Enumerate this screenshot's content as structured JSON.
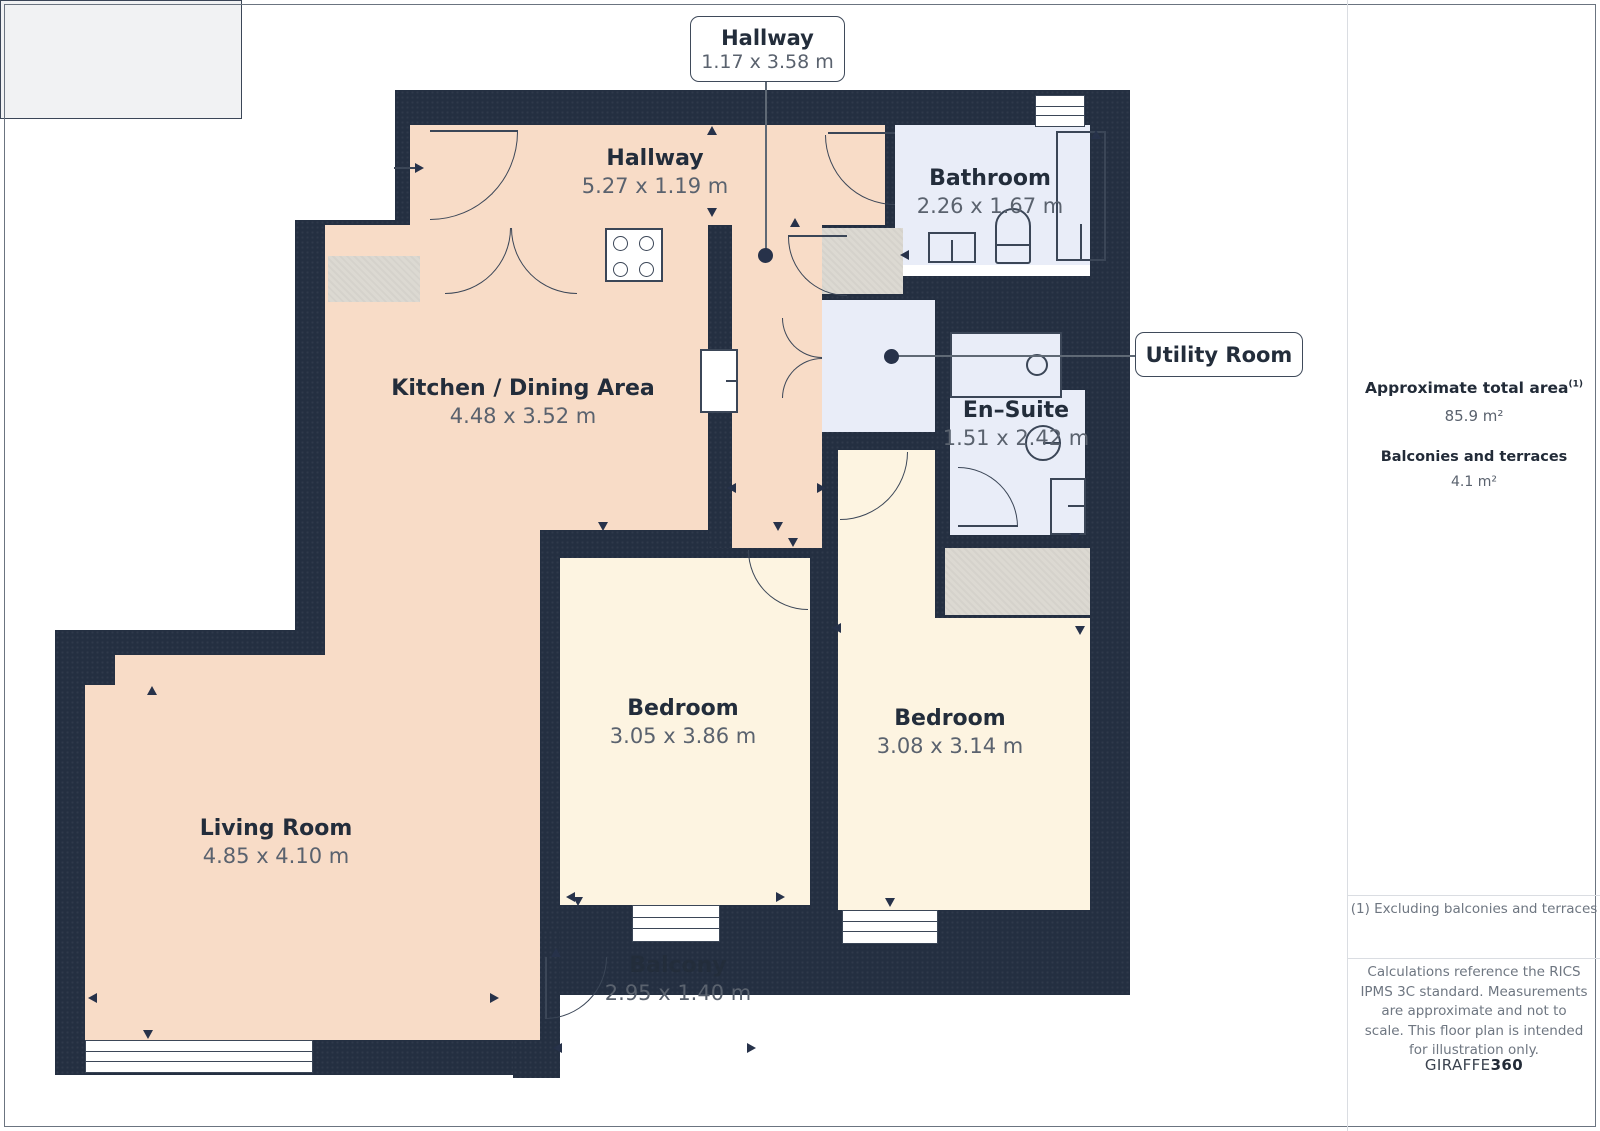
{
  "plan": {
    "rooms": {
      "hallway": {
        "name": "Hallway",
        "dims": "5.27 x 1.19 m"
      },
      "kitchen": {
        "name": "Kitchen / Dining Area",
        "dims": "4.48 x 3.52 m"
      },
      "bathroom": {
        "name": "Bathroom",
        "dims": "2.26 x 1.67 m"
      },
      "ensuite": {
        "name": "En–Suite",
        "dims": "1.51 x 2.42 m"
      },
      "bedroom1": {
        "name": "Bedroom",
        "dims": "3.05 x 3.86 m"
      },
      "bedroom2": {
        "name": "Bedroom",
        "dims": "3.08 x 3.14 m"
      },
      "living": {
        "name": "Living Room",
        "dims": "4.85 x 4.10 m"
      },
      "balcony": {
        "name": "Balcony",
        "dims": "2.95 x 1.40 m"
      }
    },
    "callouts": {
      "hallway": {
        "title": "Hallway",
        "dims": "1.17 x 3.58 m"
      },
      "utility": {
        "title": "Utility Room"
      }
    }
  },
  "sidebar": {
    "total_area_label": "Approximate total area",
    "total_area_sup": "(1)",
    "total_area_value": "85.9 m²",
    "balconies_label": "Balconies and terraces",
    "balconies_value": "4.1 m²",
    "footnote": "(1) Excluding balconies and terraces",
    "disclaimer": "Calculations reference the RICS IPMS 3C standard. Measurements are approximate and not to scale. This floor plan is intended for illustration only.",
    "brand_name": "GIRAFFE",
    "brand_suffix": "360"
  },
  "colors": {
    "wall": "#242f41",
    "floor_warm": "#f8dcc7",
    "floor_cream": "#fdf4e1",
    "floor_wet": "#e9edf8",
    "floor_balcony": "#f1f2f3",
    "closet": "#dcd9d2",
    "stroke": "#3b4657",
    "accent_dark": "#27324a"
  }
}
